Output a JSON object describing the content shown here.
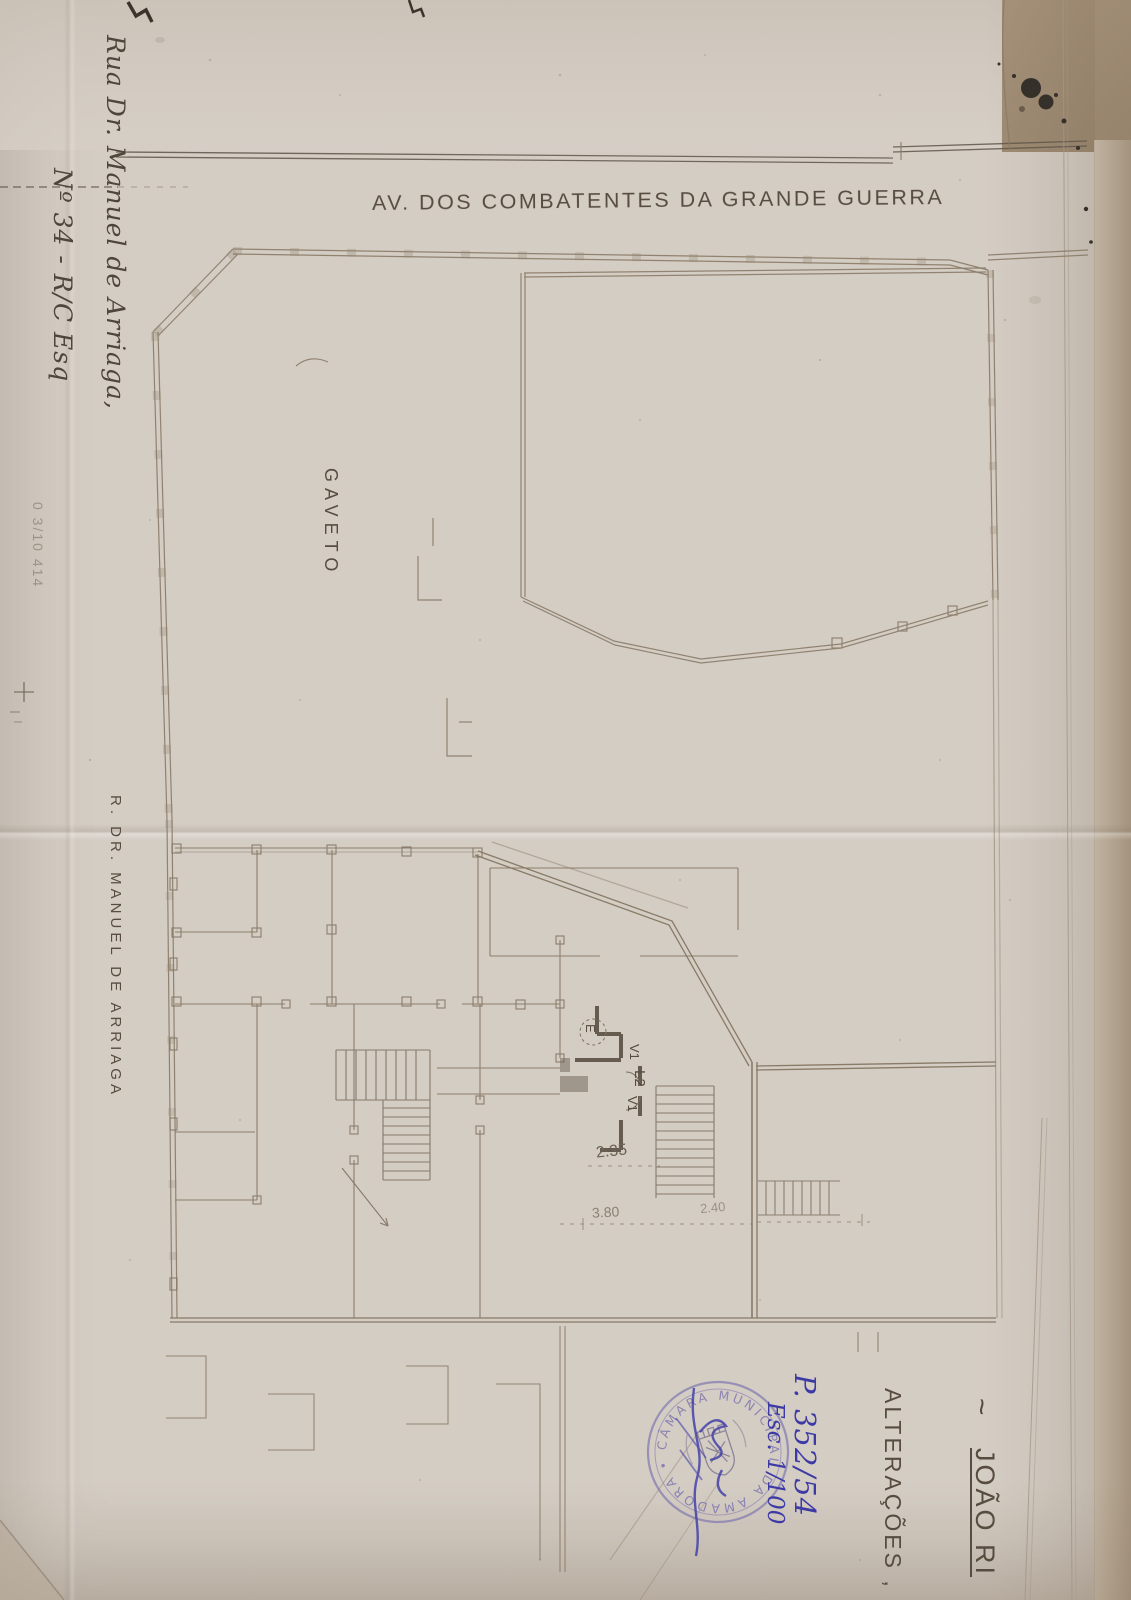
{
  "document": {
    "type": "scanned architectural floor plan",
    "colors": {
      "paper": "#d4cdc4",
      "plan_line": "#8b7c68",
      "heavy_wall": "#564c3f",
      "ink_text": "#574c3f",
      "stamp_purple": "#837cb0",
      "pen_blue": "#3d3aa6"
    }
  },
  "labels": {
    "avenue": "AV. DOS COMBATENTES DA GRANDE GUERRA",
    "gaveto": "GAVETO",
    "street_left": "R. DR. MANUEL DE ARRIAGA",
    "address_line1": "Rua Dr. Manuel de Arriaga,",
    "address_line2": "Nº 34 - R/C Esq",
    "pencil_note": "0 3/10 414"
  },
  "title_block": {
    "tilde": "~",
    "name": "JOÃO RI",
    "subject": "ALTERAÇÕES ,"
  },
  "plan_marks": {
    "elevator": "E",
    "v1_top": "V1",
    "l2": "L2",
    "v1_bottom": "V1",
    "dim_hall": "2.35",
    "dim_front": "3.80",
    "dim_side": "2.40"
  },
  "stamp": {
    "ring_text": "• CÂMARA MUNICIPAL DA AMADORA",
    "process_number": "P. 352/54",
    "scale_note": "Esc. 1/100"
  }
}
